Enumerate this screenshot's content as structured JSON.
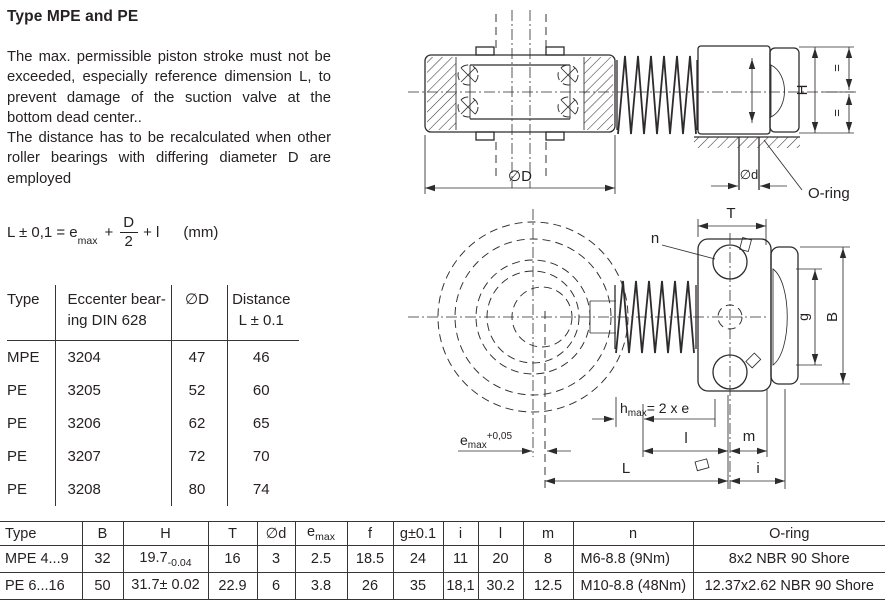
{
  "page": {
    "title": "Type MPE and PE"
  },
  "intro": {
    "para1": "The max. permissible piston stroke must not be exceeded, especially reference dimension L, to prevent damage of the suction valve at the bottom dead center..",
    "para2": "The distance has to be recalculated when other roller bearings with differing diameter D are employed"
  },
  "formula": {
    "lhs": "L ± 0,1 = e",
    "lhs_sub": "max",
    "plus1": "+",
    "frac_num": "D",
    "frac_den": "2",
    "tail": "+ l",
    "unit": "(mm)"
  },
  "bearing_table": {
    "headers": {
      "type": "Type",
      "bearing_line1": "Eccenter bear-",
      "bearing_line2": "ing DIN 628",
      "dia": "∅D",
      "distance_line1": "Distance",
      "distance_line2": "L ± 0.1"
    },
    "rows": [
      [
        "MPE",
        "3204",
        "47",
        "46"
      ],
      [
        "PE",
        "3205",
        "52",
        "60"
      ],
      [
        "PE",
        "3206",
        "62",
        "65"
      ],
      [
        "PE",
        "3207",
        "72",
        "70"
      ],
      [
        "PE",
        "3208",
        "80",
        "74"
      ]
    ]
  },
  "top_drawing": {
    "dia_D": "∅D",
    "dia_d": "∅d",
    "H": "H",
    "eq_top": "=",
    "eq_bottom": "=",
    "oring": "O-ring"
  },
  "bottom_drawing": {
    "T": "T",
    "n": "n",
    "g": "g",
    "B": "B",
    "hmax": "h",
    "hmax_sub": "max",
    "hmax_eq": "= 2 x e",
    "emax": "e",
    "emax_sub": "max",
    "emax_sup": "+0,05",
    "l": "l",
    "m": "m",
    "L": "L",
    "i": "i"
  },
  "dim_table": {
    "headers": [
      {
        "t": "Type",
        "sub": ""
      },
      {
        "t": "B",
        "sub": ""
      },
      {
        "t": "H",
        "sub": ""
      },
      {
        "t": "T",
        "sub": ""
      },
      {
        "t": "∅d",
        "sub": ""
      },
      {
        "t": "e",
        "sub": "max"
      },
      {
        "t": "f",
        "sub": ""
      },
      {
        "t": "g±0.1",
        "sub": ""
      },
      {
        "t": "i",
        "sub": ""
      },
      {
        "t": "l",
        "sub": ""
      },
      {
        "t": "m",
        "sub": ""
      },
      {
        "t": "n",
        "sub": ""
      },
      {
        "t": "O-ring",
        "sub": ""
      }
    ],
    "rows": [
      {
        "type": "MPE 4...9",
        "b": "32",
        "h": "19.7",
        "h_tol": "-0.04",
        "t": "16",
        "d": "3",
        "emax": "2.5",
        "f": "18.5",
        "g": "24",
        "i": "11",
        "l": "20",
        "m": "8",
        "n": "M6-8.8 (9Nm)",
        "oring": "8x2 NBR 90 Shore"
      },
      {
        "type": "PE 6...16",
        "b": "50",
        "h": "31.7± 0.02",
        "h_tol": "",
        "t": "22.9",
        "d": "6",
        "emax": "3.8",
        "f": "26",
        "g": "35",
        "i": "18,1",
        "l": "30.2",
        "m": "12.5",
        "n": "M10-8.8 (48Nm)",
        "oring": "12.37x2.62 NBR 90 Shore"
      }
    ]
  },
  "colors": {
    "ink": "#262122",
    "line": "#2e2b2c",
    "background": "#ffffff"
  }
}
